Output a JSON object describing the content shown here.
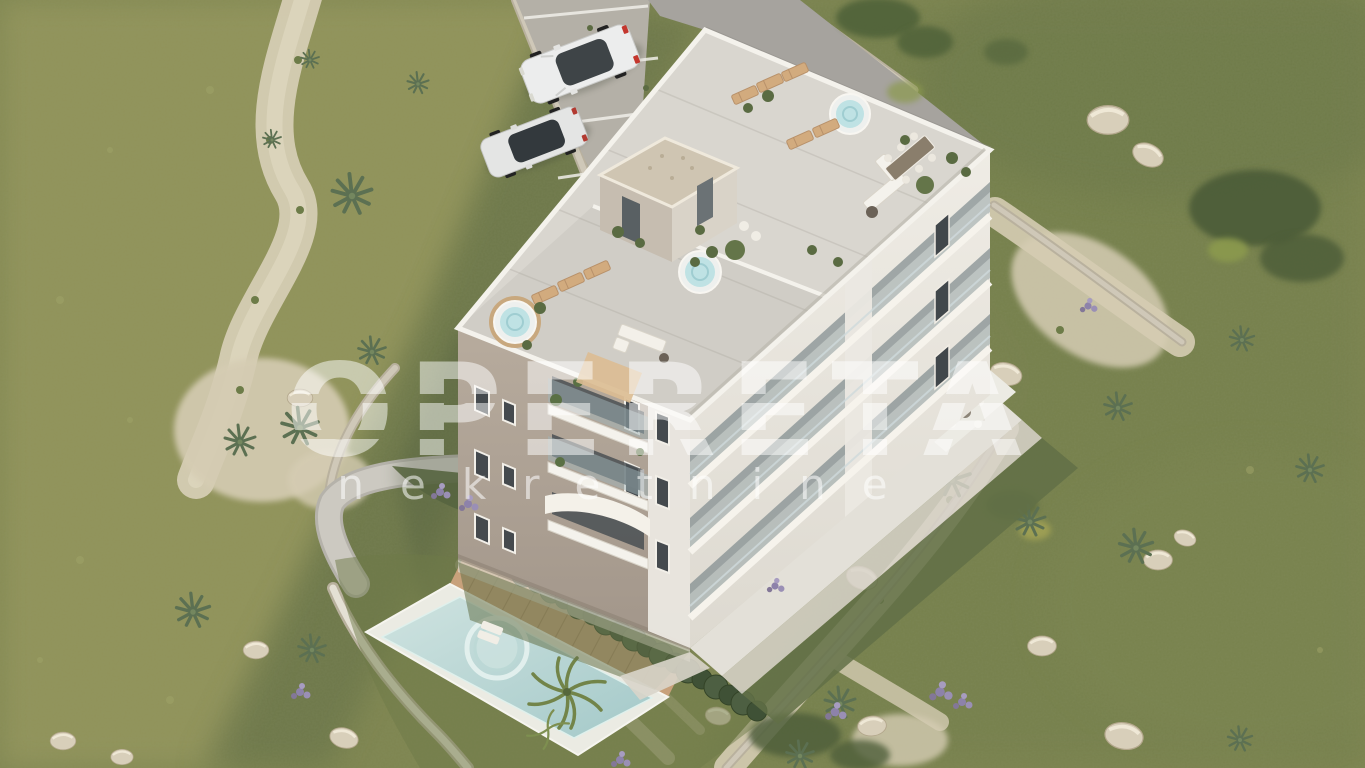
{
  "watermark": {
    "title": "OPERETA",
    "subtitle": "nekretnine"
  },
  "scene": {
    "type": "aerial-3d-architectural-render",
    "subject": "new residential apartment building with rooftop terraces, private pool, parking and Mediterranean garden",
    "counts": {
      "parked_cars": 2,
      "hot_tubs": 3,
      "swimming_pools": 1
    },
    "elements": {
      "building": "four-storey apartment building, taupe and white facades",
      "rooftop": "roof terraces with hot tubs, timber sun loungers, lounge sofas and dining set",
      "stair_tower": "rooftop stair bulkhead with gravel roof",
      "pool": "rectangular pool with round spa and timber deck",
      "hedge": "cypress hedge along pool garden",
      "parking": "gravel parking with white stall stripes and two white cars",
      "landscape": "lawn, agave plants, rocks, sandy paths, dry-stone walls, lavender shrubs"
    }
  },
  "palette": {
    "grass_base": "#7e8550",
    "grass_light": "#96975d",
    "grass_dark": "#5f6c44",
    "sand": "#d5ccb3",
    "gravel": "#b4b0a7",
    "concrete": "#a6a39e",
    "facade_taupe": "#b2a698",
    "facade_white": "#ebe8e1",
    "roof_deck": "#d9d6cf",
    "parapet": "#f4f2ec",
    "pool_water": "#b7d4d3",
    "spa_water": "#cfe4e1",
    "wood": "#c8a17b",
    "hedge": "#46563a",
    "stone_wall": "#cfc8b8",
    "rock": "#d8cfba",
    "watermark": "rgba(255,255,255,0.5)"
  }
}
